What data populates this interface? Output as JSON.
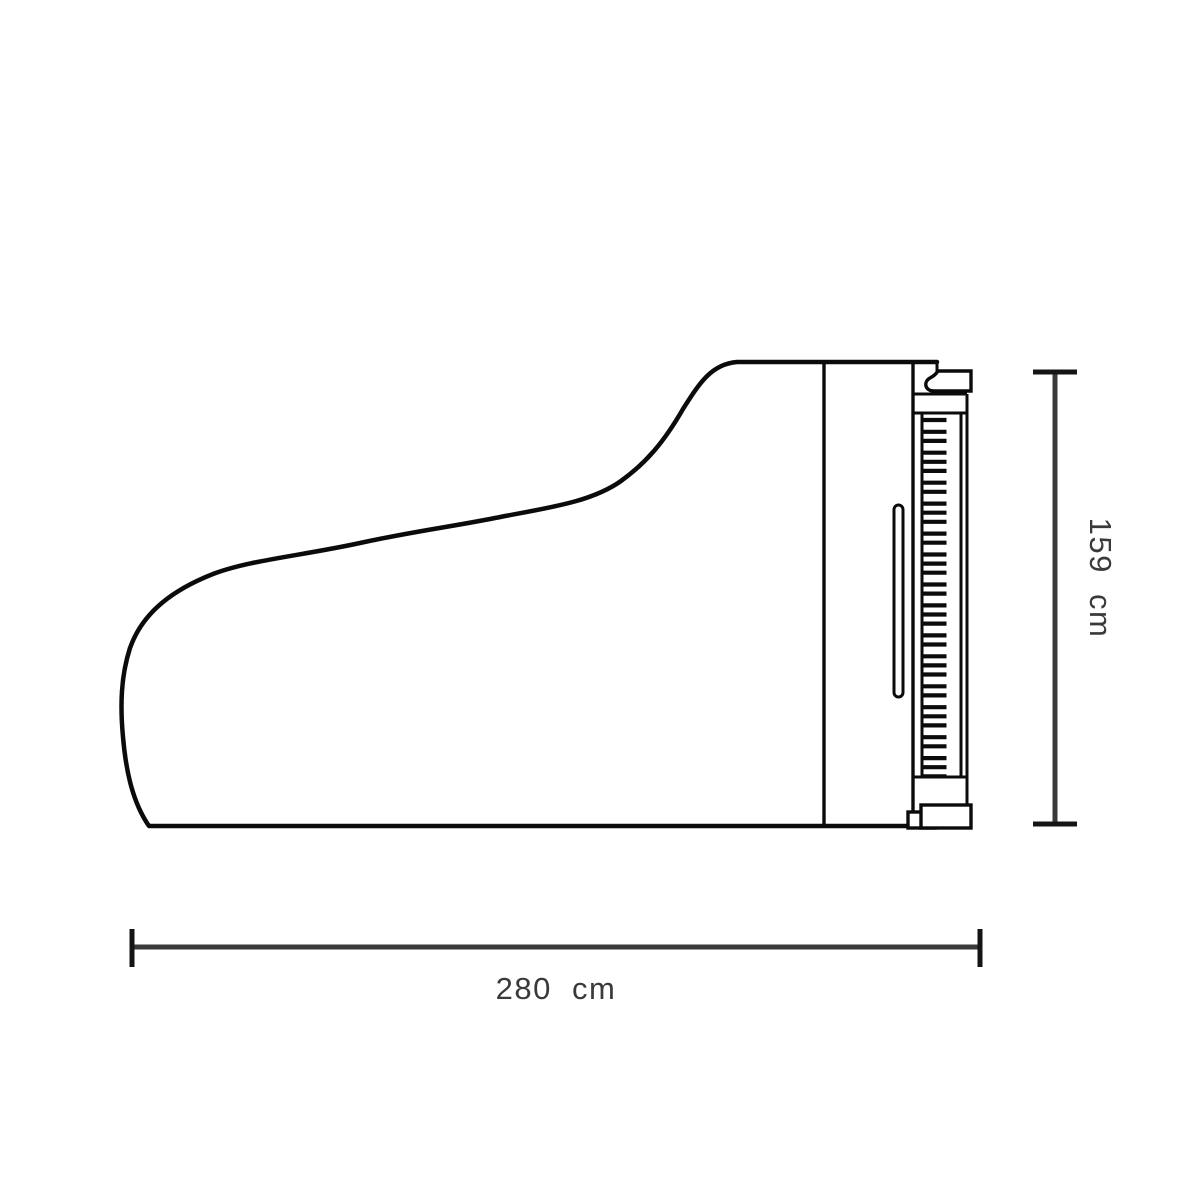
{
  "colors": {
    "outline": "#0b0b0b",
    "dimension": "#3a3a3a",
    "cap": "#141414",
    "label": "#3a3a3a",
    "background": "#ffffff"
  },
  "diagram": {
    "subject": "grand-piano-top-view-outline",
    "dimension_height": {
      "label": "159 cm",
      "value": "159",
      "unit": "cm"
    },
    "dimension_width": {
      "label": "280 cm",
      "value": "280",
      "unit": "cm"
    },
    "keyboard": {
      "black_key_groups": [
        1,
        2,
        3,
        2,
        3,
        2,
        3,
        2,
        3,
        2,
        3,
        2,
        3,
        2,
        3
      ]
    }
  }
}
